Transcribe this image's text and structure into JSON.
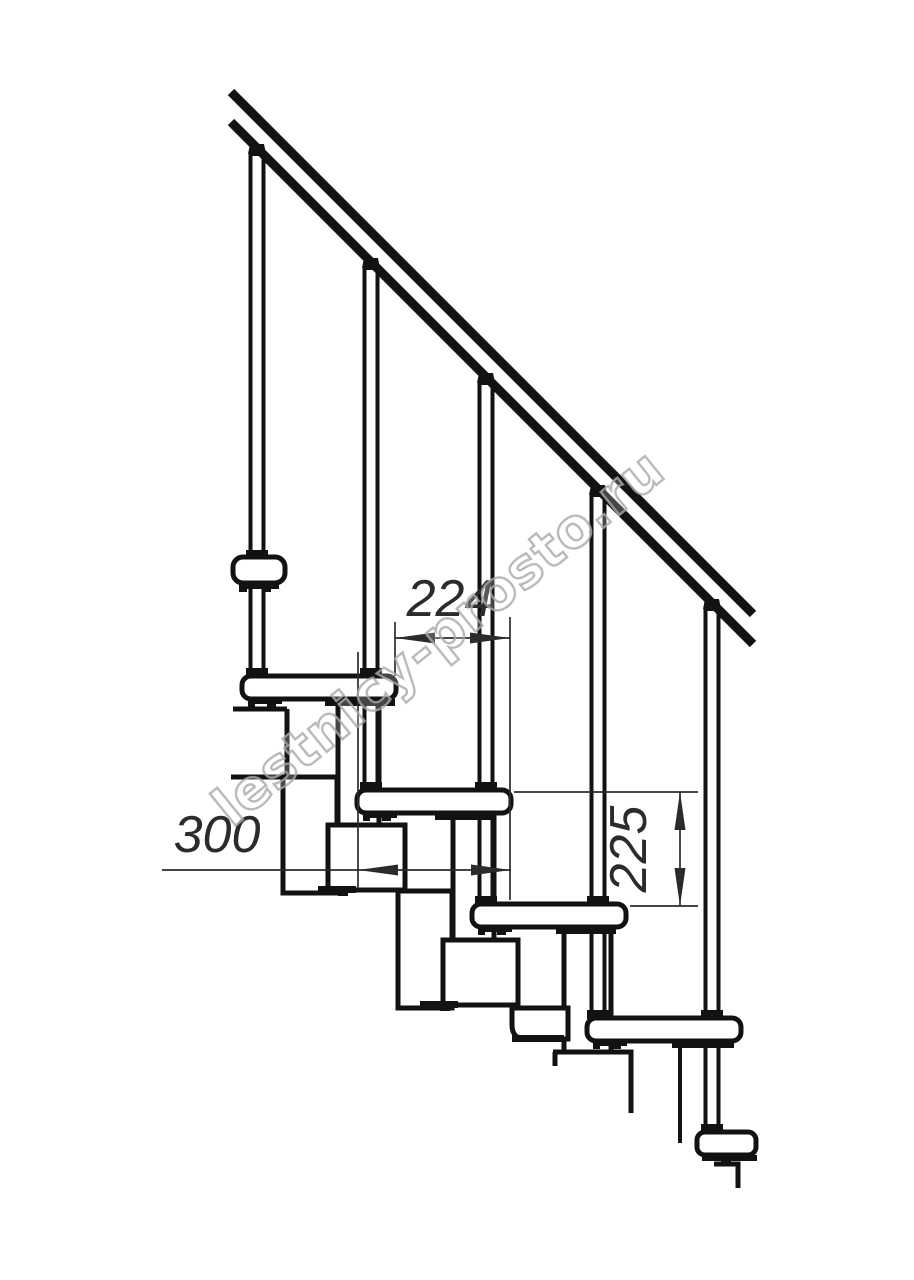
{
  "drawing": {
    "title": "modular-staircase-side-elevation",
    "watermark": "lestnicy-prosto.ru",
    "dimensions": {
      "step_run": "224",
      "tread_length": "300",
      "riser_height": "225"
    },
    "colors": {
      "line": "#121212",
      "dimension": "#2b2b2b",
      "watermark_outline": "#a9a9a9",
      "background": "#ffffff"
    }
  }
}
